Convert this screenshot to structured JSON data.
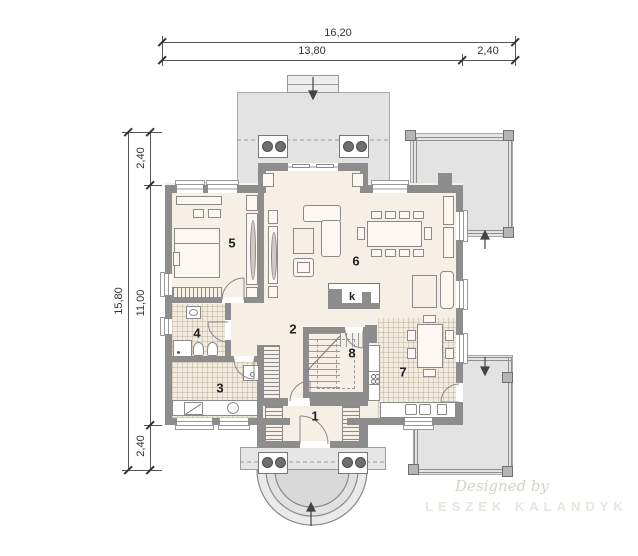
{
  "dimensions": {
    "top_total": "16,20",
    "top_main": "13,80",
    "top_side": "2,40",
    "left_total": "15,80",
    "left_top": "2,40",
    "left_main": "11,00",
    "left_bottom": "2,40"
  },
  "rooms": {
    "r1": "1",
    "r2": "2",
    "r3": "3",
    "r4": "4",
    "r5": "5",
    "r6": "6",
    "r7": "7",
    "r8": "8",
    "fireplace": "k"
  },
  "watermark": {
    "line1": "Designed by",
    "line2": "LESZEK KALANDYK"
  },
  "colors": {
    "wall": "#8d8d8d",
    "floor": "#f6efe5",
    "terrace": "#e3e3e3",
    "dimension_text": "#333333"
  }
}
